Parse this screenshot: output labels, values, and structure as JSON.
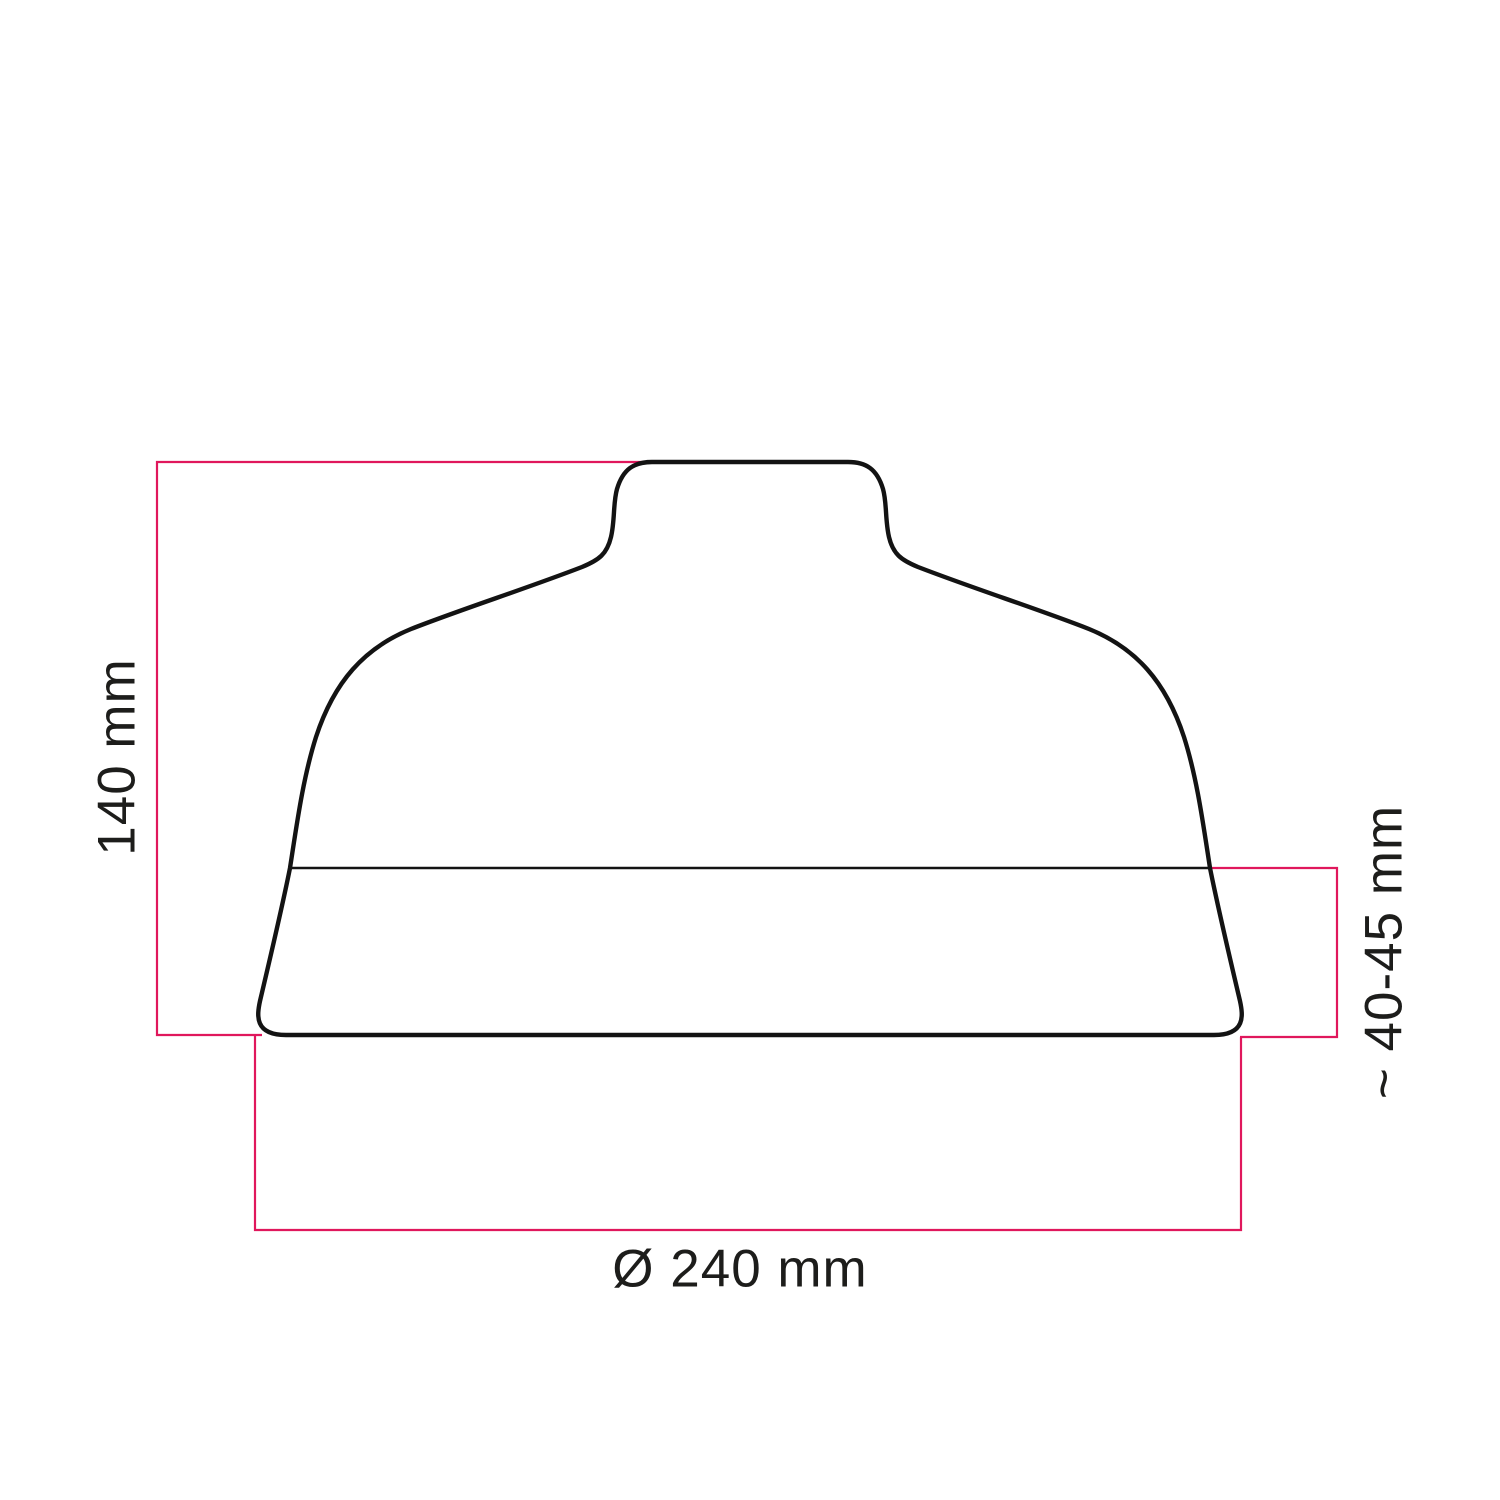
{
  "diagram": {
    "labels": {
      "height": "140 mm",
      "socket_band_height": "~ 40-45 mm",
      "diameter": "Ø 240 mm"
    },
    "colors": {
      "dimension_line": "#e0175c",
      "outline": "#131313",
      "label_text": "#1d1d1b",
      "background": "#ffffff"
    }
  }
}
